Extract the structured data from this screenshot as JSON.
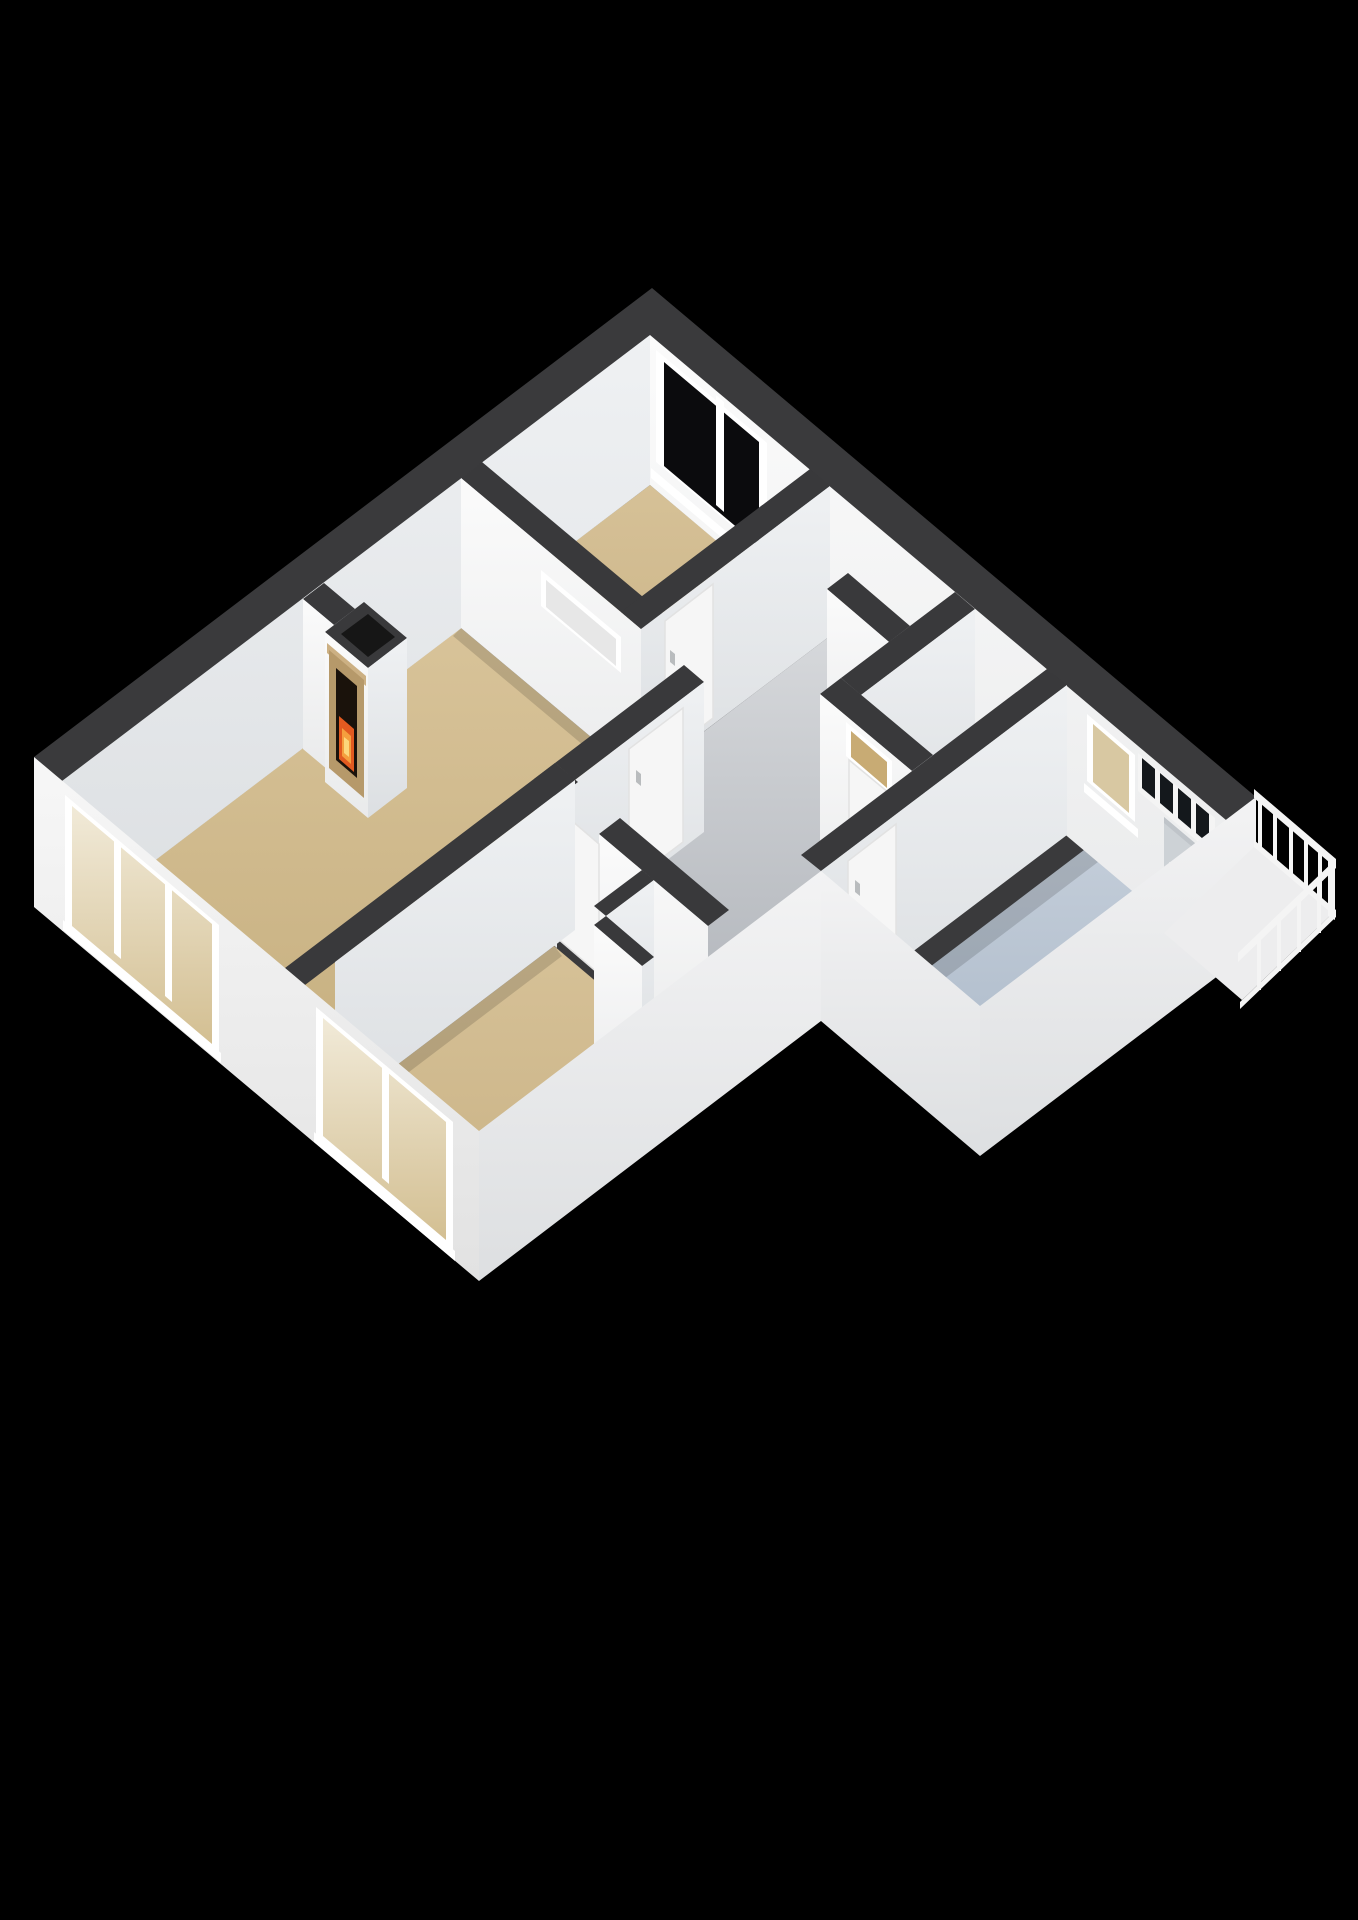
{
  "scene": {
    "type": "floorplan-3d",
    "view": "isometric-cutaway",
    "background": "#000000",
    "storey": "single-floor apartment"
  },
  "colors": {
    "background": "#000000",
    "wall_top": "#3a3a3c",
    "wall_top_inner": "#39393b",
    "chimney_shaft": "#161616",
    "floor_tan": "#cfba8e",
    "passage_tan": "#c8ad7e",
    "hall_gray": "#c6c9ce",
    "wc_gray": "#caccd0",
    "closet_gray": "#e2e2e1",
    "tech_closet_gray": "#e6e6e4",
    "bath_blue": "#b4c0cf",
    "glass_black": "#0b0b0d",
    "transom_glass": "#14181c",
    "wc_transom_glass": "#c8ab74",
    "glass_tan": "#d8c8a2",
    "door_white": "#f6f6f6",
    "door_gray": "#cdd2d6",
    "frame_white": "#ffffff",
    "handle_gray": "#b9bcbe",
    "mantel_wood": "#b6996a",
    "mantel_shelf": "#ccb083",
    "firebox": "#1a120b",
    "fire_orange": "#e25a20",
    "fire_amber": "#f59f3e",
    "fire_yellow": "#fcd77c",
    "heater_orange": "#c2592c",
    "heater_top": "#d96d39",
    "pipe_dark": "#2c2c2c",
    "toilet_white": "#fafafa",
    "toilet_shade": "#e4e5e6",
    "railing_white": "#f4f4f4",
    "fascia_white": "#ededee",
    "shadow": "rgba(0,0,0,0.14)"
  },
  "rooms": [
    {
      "id": "living-room",
      "floor": "tan",
      "features": [
        "fireplace",
        "triple-picture-window",
        "interior-transom-frame"
      ]
    },
    {
      "id": "bedroom-top",
      "floor": "tan",
      "features": [
        "black-glass-window",
        "door-to-hall"
      ]
    },
    {
      "id": "bedroom-bottom",
      "floor": "tan",
      "features": [
        "double-picture-window",
        "door-to-hall"
      ]
    },
    {
      "id": "hallway",
      "floor": "gray",
      "features": [
        "doors-to-all-rooms"
      ]
    },
    {
      "id": "passage",
      "floor": "tan",
      "features": [
        "leads-to-bathroom"
      ]
    },
    {
      "id": "wc",
      "floor": "gray",
      "features": [
        "toilet",
        "door-with-transom"
      ]
    },
    {
      "id": "storage-closet",
      "floor": "gray",
      "features": []
    },
    {
      "id": "technical-closet",
      "floor": "gray",
      "features": [
        "boiler-heater"
      ]
    },
    {
      "id": "bathroom",
      "floor": "light-blue",
      "features": [
        "window-to-balcony",
        "transom-pane-row",
        "gray-balcony-door"
      ]
    },
    {
      "id": "balcony",
      "floor": "hidden",
      "features": [
        "white-railing"
      ]
    }
  ],
  "features": {
    "fireplace": {
      "state": "lit",
      "mantel": "wood"
    },
    "balcony_railing": {
      "style": "white-balusters"
    },
    "boiler": {
      "color": "orange"
    }
  }
}
